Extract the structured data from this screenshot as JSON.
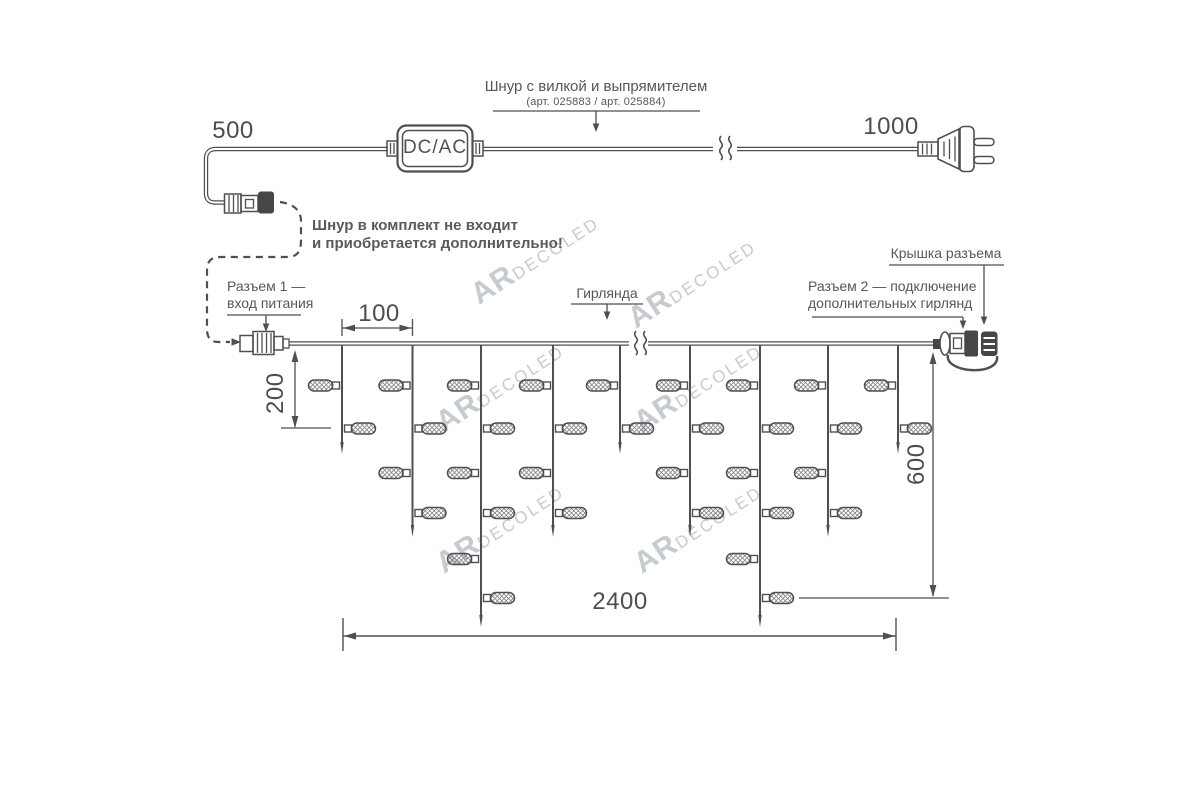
{
  "labels": {
    "cord_label": "Шнур с вилкой и выпрямителем",
    "cord_art": "(арт. 025883 / арт. 025884)",
    "note_line1": "Шнур в комплект не входит",
    "note_line2": "и приобретается дополнительно!",
    "connector1_line1": "Разъем 1 —",
    "connector1_line2": "вход питания",
    "garland": "Гирлянда",
    "cap": "Крышка разъема",
    "connector2_line1": "Разъем 2 — подключение",
    "connector2_line2": "дополнительных гирлянд",
    "converter": "DC/AC"
  },
  "dimensions": {
    "cord_to_connector": "500",
    "cord_to_plug": "1000",
    "drop_spacing": "100",
    "min_drop": "200",
    "max_drop": "600",
    "total_length": "2400"
  },
  "watermark": {
    "part1": "AR",
    "part2": "DECOLED"
  },
  "watermarks": [
    {
      "x": 535,
      "y": 258
    },
    {
      "x": 692,
      "y": 282
    },
    {
      "x": 500,
      "y": 386
    },
    {
      "x": 698,
      "y": 386
    },
    {
      "x": 500,
      "y": 527
    },
    {
      "x": 698,
      "y": 527
    }
  ],
  "colors": {
    "line": "#4e4f52",
    "text": "#56575b",
    "dark_fill": "#454648",
    "watermark": "#c6cbd1"
  },
  "garland_structure": {
    "wire_y": 343.5,
    "drop_start_y": 345,
    "bulb_levels": [
      385.5,
      428.5,
      473,
      513,
      559,
      598
    ],
    "tip_y_by_bulbs": {
      "2": 454,
      "4": 537,
      "6": 627
    },
    "drops": [
      {
        "x": 342,
        "bulbs": 2
      },
      {
        "x": 412.5,
        "bulbs": 4
      },
      {
        "x": 481,
        "bulbs": 6
      },
      {
        "x": 553,
        "bulbs": 4
      },
      {
        "x": 620,
        "bulbs": 2
      },
      {
        "x": 690,
        "bulbs": 4
      },
      {
        "x": 760,
        "bulbs": 6
      },
      {
        "x": 828,
        "bulbs": 4
      },
      {
        "x": 898,
        "bulbs": 2
      }
    ]
  }
}
